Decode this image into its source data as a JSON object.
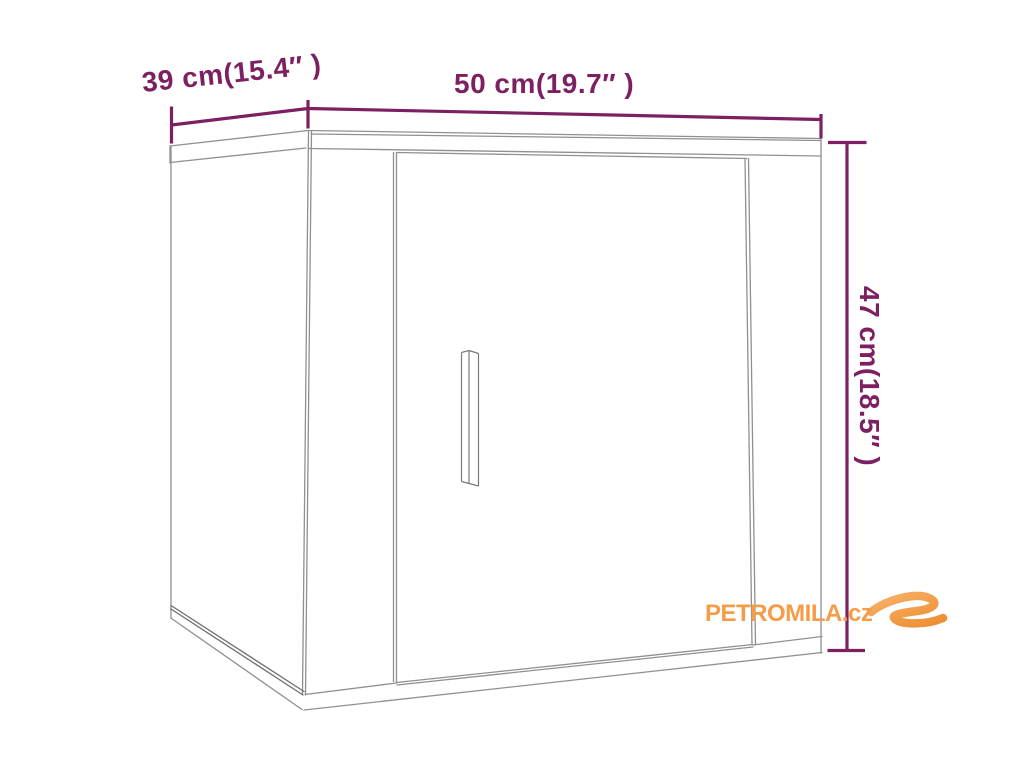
{
  "colors": {
    "dimension_purple": "#7D2062",
    "drawing_gray": "#909090",
    "drawing_dark_gray": "#6F6F6F",
    "brand_orange": "#F49C49",
    "background": "#FFFFFF"
  },
  "dimension_labels": {
    "depth": "39 cm(15.4″ )",
    "width": "50 cm(19.7″ )",
    "height": "47 cm(18.5″ )"
  },
  "watermark": {
    "brand_text": "PETROMILA.cz",
    "swoosh_icon": "brand-swoosh"
  }
}
